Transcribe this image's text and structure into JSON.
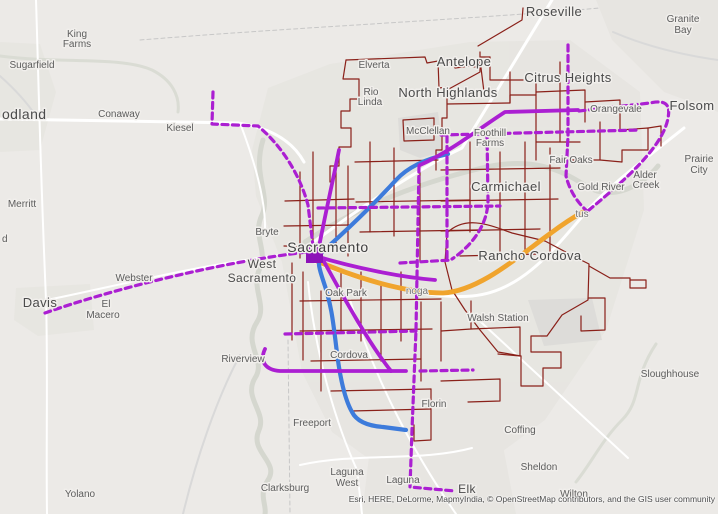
{
  "map": {
    "attribution": "Esri, HERE, DeLorme, MapmyIndia, © OpenStreetMap contributors, and the GIS user community",
    "colors": {
      "background": "#eceae7",
      "street_network": "#8a2019",
      "route_purple": "#ab1fd2",
      "route_blue": "#3d7bdb",
      "route_orange": "#f0a42d",
      "label": "#4b4b4b",
      "urban_fill": "#e3e1dd",
      "water": "#d5d7cf"
    },
    "layers": [
      {
        "name": "urban-areas",
        "kind": "polygon",
        "fill": "#e3e1dd",
        "opacity": 0.55,
        "items": [
          "252,150 268,88 330,64 470,42 570,40 640,92 644,210 606,330 545,420 480,468 384,470 332,432 302,372 282,262 256,196",
          "596,0 718,0 718,112 664,92 612,40",
          "16,288 90,284 94,330 38,336 14,320",
          "0,42 40,44 56,92 40,150 0,152",
          "372,432 500,430 516,514 362,514"
        ]
      },
      {
        "name": "field-areas",
        "kind": "polygon",
        "fill": "#dbdad7",
        "opacity": 0.8,
        "items": [
          "398,118 438,112 443,152 420,158 400,150",
          "528,300 592,298 602,340 544,346"
        ]
      },
      {
        "name": "rivers",
        "kind": "path",
        "stroke": "#d5d7cf",
        "width": 5,
        "items": [
          "M263,140 C252,175 271,195 262,215 C252,235 268,250 260,268 C250,288 268,305 257,322 C242,345 267,360 255,378 C243,398 267,412 259,430 C249,452 280,462 268,480 C258,495 267,505 265,514",
          "M305,242 C370,198 440,178 482,168 C532,156 562,170 586,186 C612,202 642,186 658,166"
        ]
      },
      {
        "name": "creeks",
        "kind": "path",
        "stroke": "#dadcd4",
        "width": 3,
        "items": [
          "M656,344 C632,380 642,400 622,420 C602,440 592,462 576,482",
          "M0,56 C60,64 120,56 152,70 C172,80 180,96 178,112"
        ]
      },
      {
        "name": "gray-roads",
        "kind": "path",
        "stroke": "#d9d9d9",
        "width": 2,
        "items": [
          "M240,355 C216,400 196,460 183,514",
          "M613,32 C650,48 690,56 718,60",
          "M0,76 C18,92 28,104 36,116"
        ]
      },
      {
        "name": "county-lines",
        "kind": "path",
        "stroke": "#c7c7c7",
        "width": 1,
        "dash": "4 3",
        "items": [
          "M140,40 C300,27 460,20 600,8",
          "M288,340 L290,514"
        ]
      },
      {
        "name": "white-roads-major",
        "kind": "path",
        "stroke": "#ffffff",
        "width": 3,
        "items": [
          "M0,119 L238,123 C272,128 293,142 304,162",
          "M303,250 C360,207 420,168 462,148 L552,0",
          "M310,260 C390,294 450,298 472,296 C520,292 552,252 586,212 C612,183 644,160 684,128"
        ]
      },
      {
        "name": "white-roads",
        "kind": "path",
        "stroke": "#ffffff",
        "width": 2,
        "items": [
          "M36,0 C38,60 40,160 46,300 C48,360 46,450 47,514",
          "M47,300 C130,283 210,262 306,252",
          "M308,282 C316,360 338,428 357,470 L362,514",
          "M350,300 C378,388 416,456 456,514",
          "M470,312 L628,458",
          "M300,465 C360,452 420,462 472,448",
          "M240,123 C258,170 266,205 265,232"
        ]
      },
      {
        "name": "street-network",
        "kind": "path",
        "stroke": "#8a2019",
        "width": 1.2,
        "items": [
          "M346,60 L425,57 L427,63 L438,61 L439,88 L447,87 L447,118 L442,118 L442,150 L436,150 L436,170",
          "M346,60 L343,79 L359,79 L359,99 L350,99 L350,111 L341,111 L341,128 L351,128 L351,147 L339,147 L339,166 L330,166 L330,182",
          "M438,64 L452,62 L455,68 L470,66 L481,68 L481,57 L490,57",
          "M481,68 L484,92 L447,92",
          "M447,104 L510,103 L510,95 L536,95",
          "M536,72 L536,160",
          "M510,72 L510,103",
          "M490,57 L490,80 L523,80",
          "M536,92 L585,90 L585,122",
          "M560,62 L560,142",
          "M585,102 L620,100 L620,130",
          "M600,122 L600,160 L572,160",
          "M536,142 L580,142",
          "M620,130 L648,128 L648,150 L622,150 L622,162 L600,160",
          "M648,128 L661,126 L661,146",
          "M478,46 L522,20 L523,8",
          "M480,52 L480,72 L447,90",
          "M403,120 L434,118 L434,140 L404,141 L403,120",
          "M355,162 L438,160",
          "M370,142 L370,232",
          "M394,148 L394,236",
          "M420,172 L420,262",
          "M356,202 L470,200",
          "M360,232 L478,230",
          "M441,170 L560,168",
          "M470,142 L470,232",
          "M500,152 L500,252",
          "M525,142 L525,258",
          "M550,148 L550,252",
          "M441,201 L558,199",
          "M441,231 L540,229",
          "M460,256 L540,254",
          "M336,170 L336,250",
          "M300,172 L300,258",
          "M313,152 L313,250",
          "M285,201 L354,199",
          "M284,226 L350,225",
          "M284,246 L342,247",
          "M348,166 L348,256",
          "M292,263 L292,340",
          "M303,272 L303,360",
          "M321,291 L321,391",
          "M341,272 L341,333",
          "M361,272 L361,341",
          "M381,282 L381,361",
          "M401,272 L401,341",
          "M421,302 L421,381",
          "M441,302 L441,361",
          "M300,301 L441,299",
          "M300,331 L432,329",
          "M311,361 L421,359",
          "M331,391 L431,389",
          "M351,411 L431,409",
          "M431,389 L431,440 L414,441 L414,425",
          "M441,331 L471,329 L471,301",
          "M471,329 L520,327 L520,356 L498,354",
          "M441,381 L500,379 L500,401 L468,402",
          "M447,233 C466,214 492,226 512,233 L545,241 L577,258 L589,264 L588,300 L562,315 L547,336 L531,336 L531,352 L561,352 L561,368 L543,368 L543,386 L521,386 L521,356",
          "M447,233 L445,262 L452,290 L465,310 L480,330 L498,352 L521,356",
          "M589,266 L610,278 L630,278 L630,288 L646,288 L646,280 L630,280",
          "M588,298 L605,298 L605,330 L581,331 L581,316"
        ]
      },
      {
        "name": "route-orange",
        "kind": "path",
        "stroke": "#f0a42d",
        "width": 4.8,
        "items": [
          "M310,258 C355,278 405,293 443,293 C480,291 520,255 551,233 C563,224 572,218 583,212"
        ]
      },
      {
        "name": "route-blue",
        "kind": "path",
        "stroke": "#3d7bdb",
        "width": 4.2,
        "items": [
          "M448,154 C425,159 407,168 396,180 C375,203 345,232 322,252 C316,262 320,270 323,280 C331,303 333,320 336,345 C339,372 344,398 352,412 C357,422 370,426 383,427 L406,430"
        ]
      },
      {
        "name": "route-purple-solid",
        "kind": "path",
        "stroke": "#ab1fd2",
        "width": 3.8,
        "items": [
          "M420,165 C450,152 480,128 505,112 L578,110",
          "M265,349 C259,362 266,370 280,371 L406,371",
          "M312,255 C355,268 400,277 435,280",
          "M318,252 C325,215 331,190 339,150",
          "M322,258 C345,300 370,345 391,371"
        ]
      },
      {
        "name": "transit-hub",
        "kind": "polygon",
        "fill": "#8d12b8",
        "opacity": 1,
        "items": [
          "306,245 323,245 323,263 306,263"
        ]
      },
      {
        "name": "route-purple-dashed",
        "kind": "path",
        "stroke": "#ab1fd2",
        "width": 3.2,
        "dash": "6 4.5",
        "items": [
          "M45,313 C110,290 220,262 307,252",
          "M213,92 L212,124 L258,126 C282,146 300,175 308,205 L313,246",
          "M568,45 L568,136 L566,176 C570,192 578,203 587,211",
          "M579,111 L650,103 C664,100 671,103 668,118 C663,147 625,180 589,210",
          "M441,135 L640,130",
          "M487,133 L488,200 C488,226 470,247 452,259",
          "M318,208 L500,206",
          "M400,263 L452,260",
          "M447,136 L447,261",
          "M419,166 L416,330 L412,430 L410,487 L455,491",
          "M285,334 L416,331",
          "M420,371 L473,370"
        ]
      }
    ],
    "labels": [
      {
        "t": "Roseville",
        "x": 554,
        "y": 16,
        "s": 13,
        "c": "city"
      },
      {
        "t": "Granite",
        "x": 683,
        "y": 22,
        "s": 10,
        "c": "town"
      },
      {
        "t": "Bay",
        "x": 683,
        "y": 33,
        "s": 10,
        "c": "town"
      },
      {
        "t": "King",
        "x": 77,
        "y": 37,
        "s": 10,
        "c": "town"
      },
      {
        "t": "Farms",
        "x": 77,
        "y": 47,
        "s": 10,
        "c": "town"
      },
      {
        "t": "Sugarfield",
        "x": 32,
        "y": 68,
        "s": 10,
        "c": "town"
      },
      {
        "t": "odland",
        "x": 2,
        "y": 119,
        "s": 14,
        "c": "city",
        "a": "start"
      },
      {
        "t": "Conaway",
        "x": 119,
        "y": 117,
        "s": 10,
        "c": "town"
      },
      {
        "t": "Kiesel",
        "x": 180,
        "y": 131,
        "s": 10,
        "c": "town"
      },
      {
        "t": "Merritt",
        "x": 22,
        "y": 207,
        "s": 10,
        "c": "town"
      },
      {
        "t": "d",
        "x": 2,
        "y": 242,
        "s": 10,
        "c": "town",
        "a": "start"
      },
      {
        "t": "Davis",
        "x": 40,
        "y": 307,
        "s": 13,
        "c": "city"
      },
      {
        "t": "Webster",
        "x": 134,
        "y": 281,
        "s": 10,
        "c": "town"
      },
      {
        "t": "El",
        "x": 106,
        "y": 307,
        "s": 10,
        "c": "town"
      },
      {
        "t": "Macero",
        "x": 103,
        "y": 318,
        "s": 10,
        "c": "town"
      },
      {
        "t": "Bryte",
        "x": 267,
        "y": 235,
        "s": 10,
        "c": "town"
      },
      {
        "t": "Sacramento",
        "x": 328,
        "y": 252,
        "s": 14,
        "c": "big"
      },
      {
        "t": "West",
        "x": 262,
        "y": 268,
        "s": 12,
        "c": "city"
      },
      {
        "t": "Sacramento",
        "x": 262,
        "y": 282,
        "s": 12,
        "c": "city"
      },
      {
        "t": "Elverta",
        "x": 374,
        "y": 68,
        "s": 10,
        "c": "town"
      },
      {
        "t": "Rio",
        "x": 371,
        "y": 95,
        "s": 10,
        "c": "town"
      },
      {
        "t": "Linda",
        "x": 370,
        "y": 105,
        "s": 10,
        "c": "town"
      },
      {
        "t": "Antelope",
        "x": 464,
        "y": 66,
        "s": 13,
        "c": "city"
      },
      {
        "t": "North Highlands",
        "x": 448,
        "y": 97,
        "s": 13,
        "c": "city"
      },
      {
        "t": "McClellan",
        "x": 428,
        "y": 134,
        "s": 10,
        "c": "town"
      },
      {
        "t": "Citrus Heights",
        "x": 568,
        "y": 82,
        "s": 13,
        "c": "city"
      },
      {
        "t": "Foothill",
        "x": 490,
        "y": 136,
        "s": 10,
        "c": "town"
      },
      {
        "t": "Farms",
        "x": 490,
        "y": 146,
        "s": 10,
        "c": "town"
      },
      {
        "t": "Orangevale",
        "x": 616,
        "y": 112,
        "s": 10,
        "c": "town"
      },
      {
        "t": "Folsom",
        "x": 692,
        "y": 110,
        "s": 13,
        "c": "city"
      },
      {
        "t": "Fair Oaks",
        "x": 571,
        "y": 163,
        "s": 10,
        "c": "town"
      },
      {
        "t": "Prairie",
        "x": 699,
        "y": 162,
        "s": 10,
        "c": "town"
      },
      {
        "t": "City",
        "x": 699,
        "y": 173,
        "s": 10,
        "c": "town"
      },
      {
        "t": "Alder",
        "x": 645,
        "y": 178,
        "s": 10,
        "c": "town"
      },
      {
        "t": "Creek",
        "x": 646,
        "y": 188,
        "s": 10,
        "c": "town"
      },
      {
        "t": "Gold River",
        "x": 601,
        "y": 190,
        "s": 10,
        "c": "town"
      },
      {
        "t": "tus",
        "x": 582,
        "y": 217,
        "s": 10,
        "c": "muted"
      },
      {
        "t": "Carmichael",
        "x": 506,
        "y": 191,
        "s": 13,
        "c": "city"
      },
      {
        "t": "Rancho Cordova",
        "x": 530,
        "y": 260,
        "s": 13,
        "c": "city"
      },
      {
        "t": "Walsh Station",
        "x": 498,
        "y": 321,
        "s": 10,
        "c": "town"
      },
      {
        "t": "noga",
        "x": 417,
        "y": 294,
        "s": 10,
        "c": "muted"
      },
      {
        "t": "Oak Park",
        "x": 346,
        "y": 296,
        "s": 10,
        "c": "town"
      },
      {
        "t": "Cordova",
        "x": 349,
        "y": 358,
        "s": 10,
        "c": "town"
      },
      {
        "t": "Riverview",
        "x": 243,
        "y": 362,
        "s": 10,
        "c": "town"
      },
      {
        "t": "Florin",
        "x": 434,
        "y": 407,
        "s": 10,
        "c": "town"
      },
      {
        "t": "Freeport",
        "x": 312,
        "y": 426,
        "s": 10,
        "c": "town"
      },
      {
        "t": "Laguna",
        "x": 347,
        "y": 475,
        "s": 10,
        "c": "town"
      },
      {
        "t": "West",
        "x": 347,
        "y": 486,
        "s": 10,
        "c": "town"
      },
      {
        "t": "Laguna",
        "x": 403,
        "y": 483,
        "s": 10,
        "c": "town"
      },
      {
        "t": "Clarksburg",
        "x": 285,
        "y": 491,
        "s": 10,
        "c": "town"
      },
      {
        "t": "Yolano",
        "x": 80,
        "y": 497,
        "s": 10,
        "c": "town"
      },
      {
        "t": "Elk",
        "x": 467,
        "y": 493,
        "s": 12,
        "c": "city"
      },
      {
        "t": "Sloughhouse",
        "x": 670,
        "y": 377,
        "s": 10,
        "c": "town"
      },
      {
        "t": "Coffing",
        "x": 520,
        "y": 433,
        "s": 10,
        "c": "town"
      },
      {
        "t": "Sheldon",
        "x": 539,
        "y": 470,
        "s": 10,
        "c": "town"
      },
      {
        "t": "Wilton",
        "x": 574,
        "y": 497,
        "s": 10,
        "c": "town"
      }
    ]
  }
}
